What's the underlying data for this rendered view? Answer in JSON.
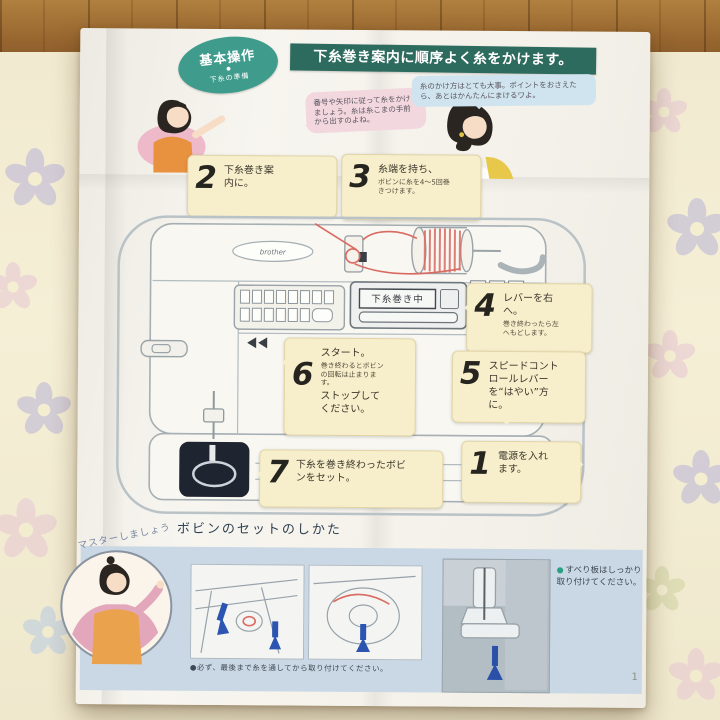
{
  "colors": {
    "badge_teal": "#3f9c8c",
    "title_bar_green": "#2e6b5f",
    "note_cream": "#f7eecb",
    "band_blue": "#c9d8e4",
    "thread_red": "#d96a62",
    "arrow_blue": "#2b55b0",
    "bullet_green": "#2aa183",
    "tablecloth": "#f3eccf",
    "wood": "#96652f"
  },
  "header": {
    "badge_title": "基本操作",
    "badge_dot": "●",
    "badge_subtitle": "下糸の準備",
    "title": "下糸巻き案内に順序よく糸をかけます。"
  },
  "speech": {
    "left": "番号や矢印に従って糸をかけましょう。糸は糸こまの手前から出すのよね。",
    "right": "糸のかけ方はとても大事。ポイントをおさえたら、あとはかんたんにまけるワよ。"
  },
  "steps": {
    "s1": {
      "num": "1",
      "text": "電源を入れます。"
    },
    "s2": {
      "num": "2",
      "text": "下糸巻き案内に。"
    },
    "s3": {
      "num": "3",
      "text": "糸端を持ち、",
      "small": "ボビンに糸を4〜5回巻きつけます。"
    },
    "s4": {
      "num": "4",
      "text": "レバーを右へ。",
      "small": "巻き終わったら左へもどします。"
    },
    "s5": {
      "num": "5",
      "text": "スピードコントロールレバーを“はやい”方に。"
    },
    "s6": {
      "num": "6",
      "text": "スタート。",
      "small": "巻き終わるとボビンの回転は止まります。",
      "text2": "ストップしてください。"
    },
    "s7": {
      "num": "7",
      "text": "下糸を巻き終わったボビンをセット。"
    }
  },
  "machine": {
    "lcd_text": "下糸巻き中",
    "brand": "brother"
  },
  "bottom": {
    "heading": "ボビンのセットのしかた",
    "master": "マスターしましょう",
    "note_bullet": "●",
    "note": "すべり板はしっかり取り付けてください。",
    "caption": "●必ず、最後まで糸を通してから取り付けてください。",
    "page_number": "1"
  }
}
